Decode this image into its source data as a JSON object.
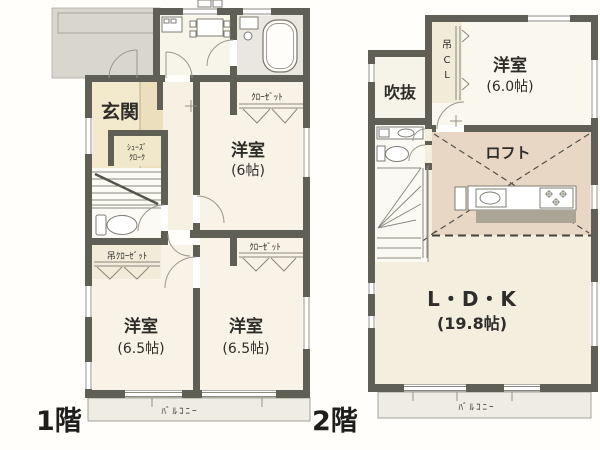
{
  "colors": {
    "wall": "#605f56",
    "room_cream": "#f8f3e6",
    "genkan_yellow": "#f3e9cd",
    "porch_gray": "#d9d6d0",
    "loft_pink": "#e9d7c5",
    "balcony": "#eeece3",
    "bath_gray": "#e9e7df"
  },
  "floor1": {
    "label": "1階",
    "genkan": {
      "label": "玄関"
    },
    "bedroom6": {
      "label": "洋室",
      "size": "(6帖)"
    },
    "bedroom65a": {
      "label": "洋室",
      "size": "(6.5帖)"
    },
    "bedroom65b": {
      "label": "洋室",
      "size": "(6.5帖)"
    },
    "closet_upper": {
      "label": "ｸﾛｰｾﾞｯﾄ"
    },
    "closet_lower": {
      "label": "ｸﾛｰｾﾞｯﾄ"
    },
    "hanging_closet": {
      "label": "吊ｸﾛｰｾﾞｯﾄ"
    },
    "shoes_closet": {
      "line1": "ｼｭｰｽﾞ",
      "line2": "ｸﾛｰｸ"
    },
    "balcony": {
      "label": "ﾊﾞﾙｺﾆｰ"
    }
  },
  "floor2": {
    "label": "2階",
    "void": {
      "label": "吹抜"
    },
    "hanging_cl": {
      "c1": "吊",
      "c2": "C",
      "c3": "L"
    },
    "bedroom6": {
      "label": "洋室",
      "size": "(6.0帖)"
    },
    "loft": {
      "label": "ロフト"
    },
    "ldk": {
      "label": "L・D・K",
      "size": "(19.8帖)"
    },
    "balcony": {
      "label": "ﾊﾞﾙｺﾆｰ"
    }
  }
}
